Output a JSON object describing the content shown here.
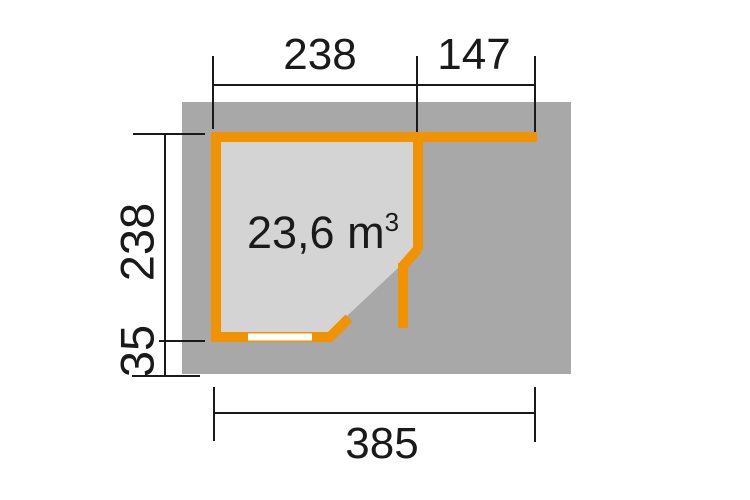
{
  "colors": {
    "background": "#ffffff",
    "base_gray": "#a8a8a8",
    "interior_gray": "#d4d4d4",
    "wall_orange": "#f19300",
    "window_white": "#ffffff",
    "line_black": "#1a1a1a",
    "text_black": "#1a1a1a"
  },
  "annotations": {
    "top_dim_main": "238",
    "top_dim_side": "147",
    "left_dim_depth": "238",
    "left_dim_overhang": "35",
    "bottom_dim_total": "385",
    "volume_text": "23,6 m",
    "volume_sup": "3"
  }
}
